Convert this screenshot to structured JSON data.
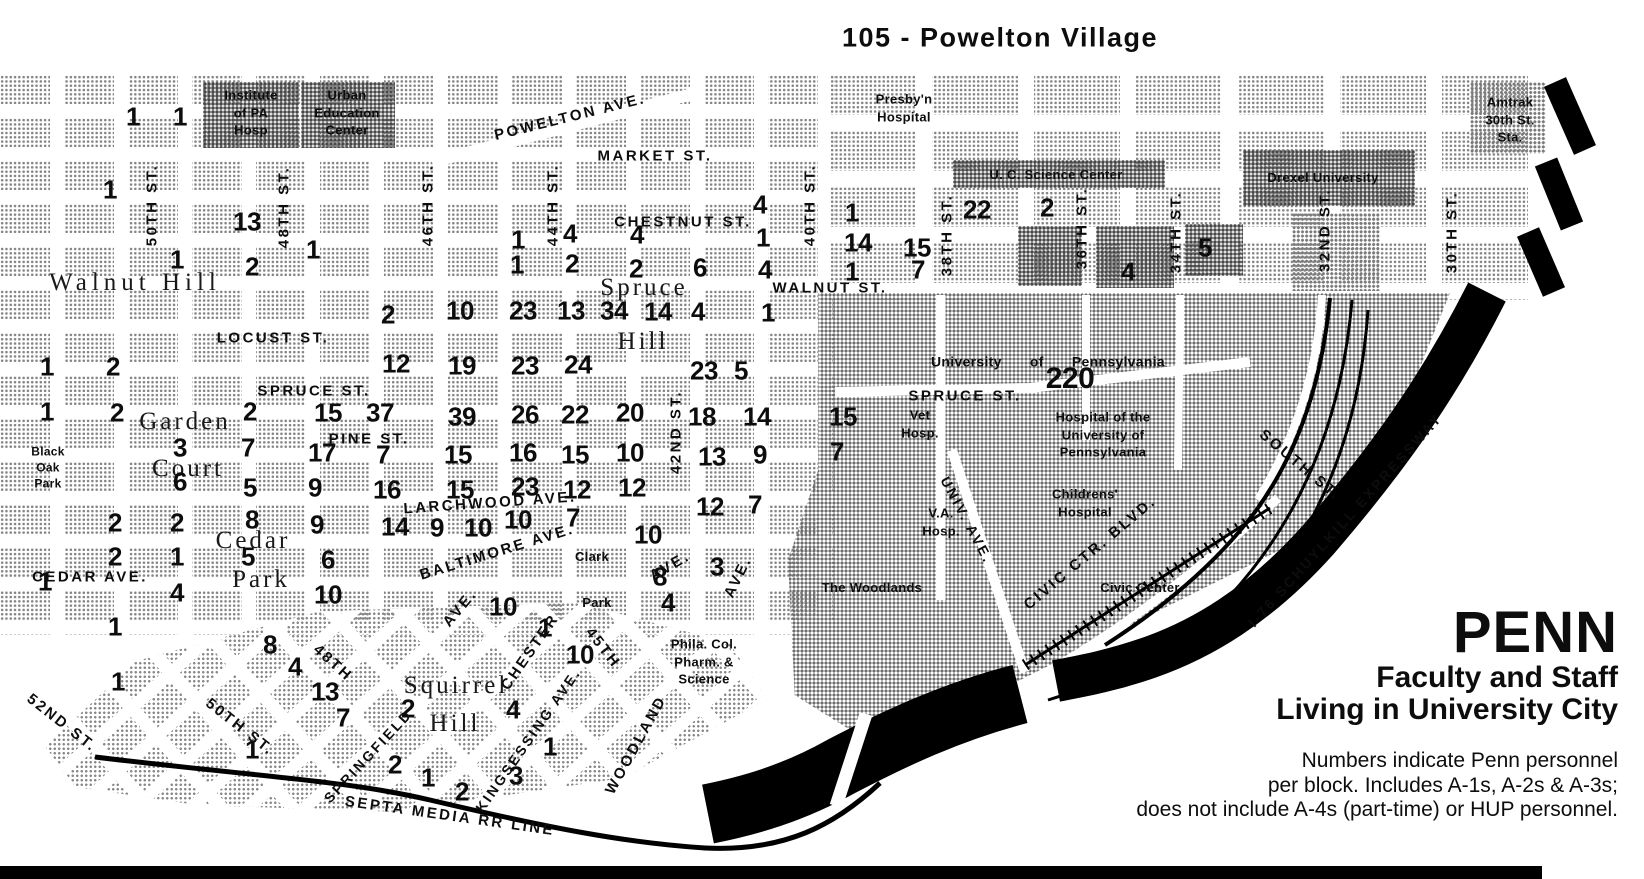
{
  "title": "105  - Powelton Village",
  "legend": {
    "brand": "PENN",
    "subtitle1": "Faculty and Staff",
    "subtitle2": "Living in University City",
    "note1": "Numbers indicate Penn personnel",
    "note2": "per block. Includes A-1s, A-2s & A-3s;",
    "note3": "does not include A-4s (part-time) or HUP personnel."
  },
  "colors": {
    "ink": "#0d0d0d",
    "paper": "#ffffff",
    "halftone_light": "#848484",
    "halftone_dark": "#474747"
  },
  "map": {
    "street_labels": [
      {
        "t": "POWELTON AVE.",
        "x": 570,
        "y": 117,
        "r": -14
      },
      {
        "t": "MARKET  ST.",
        "x": 655,
        "y": 156
      },
      {
        "t": "CHESTNUT  ST.",
        "x": 683,
        "y": 222
      },
      {
        "t": "WALNUT  ST.",
        "x": 830,
        "y": 288
      },
      {
        "t": "LOCUST ST.",
        "x": 273,
        "y": 338
      },
      {
        "t": "SPRUCE  ST.",
        "x": 314,
        "y": 391
      },
      {
        "t": "PINE  ST.",
        "x": 369,
        "y": 439
      },
      {
        "t": "LARCHWOOD AVE.",
        "x": 490,
        "y": 503,
        "r": -4
      },
      {
        "t": "BALTIMORE AVE.",
        "x": 497,
        "y": 552,
        "r": -17
      },
      {
        "t": "CEDAR  AVE.",
        "x": 90,
        "y": 577
      },
      {
        "t": "SPRUCE  ST.",
        "x": 965,
        "y": 396
      },
      {
        "t": "50TH ST.",
        "x": 152,
        "y": 205,
        "r": -90
      },
      {
        "t": "48TH ST.",
        "x": 284,
        "y": 207,
        "r": -90
      },
      {
        "t": "46TH ST.",
        "x": 428,
        "y": 205,
        "r": -90
      },
      {
        "t": "44TH ST.",
        "x": 553,
        "y": 205,
        "r": -90
      },
      {
        "t": "42ND ST.",
        "x": 676,
        "y": 432,
        "r": -90
      },
      {
        "t": "40TH ST.",
        "x": 810,
        "y": 205,
        "r": -90
      },
      {
        "t": "38TH ST.",
        "x": 947,
        "y": 235,
        "r": -90
      },
      {
        "t": "36TH ST.",
        "x": 1082,
        "y": 228,
        "r": -90
      },
      {
        "t": "34TH ST.",
        "x": 1176,
        "y": 232,
        "r": -90
      },
      {
        "t": "32ND ST.",
        "x": 1325,
        "y": 230,
        "r": -90
      },
      {
        "t": "30TH ST.",
        "x": 1452,
        "y": 232,
        "r": -90
      },
      {
        "t": "52ND  ST.",
        "x": 62,
        "y": 723,
        "r": 38
      },
      {
        "t": "50TH  ST.",
        "x": 240,
        "y": 727,
        "r": 38
      },
      {
        "t": "48TH",
        "x": 333,
        "y": 663,
        "r": 42
      },
      {
        "t": "45TH",
        "x": 603,
        "y": 648,
        "r": 52
      },
      {
        "t": "SPRINGFIELD",
        "x": 368,
        "y": 756,
        "r": -47,
        "fs": 14
      },
      {
        "t": "CHESTER",
        "x": 530,
        "y": 652,
        "r": -55
      },
      {
        "t": "AVE.",
        "x": 460,
        "y": 608,
        "r": -50
      },
      {
        "t": "KINGSESSING AVE.",
        "x": 528,
        "y": 740,
        "r": -55,
        "fs": 14
      },
      {
        "t": "WOODLAND",
        "x": 636,
        "y": 745,
        "r": -61
      },
      {
        "t": "AVE.",
        "x": 670,
        "y": 566,
        "r": -30
      },
      {
        "t": "AVE.",
        "x": 738,
        "y": 577,
        "r": -64
      },
      {
        "t": "SEPTA MEDIA RR LINE",
        "x": 450,
        "y": 816,
        "r": 8
      },
      {
        "t": "UNIV. AVE.",
        "x": 967,
        "y": 520,
        "r": 62,
        "fs": 14
      },
      {
        "t": "CIVIC CTR. BLVD.",
        "x": 1090,
        "y": 553,
        "r": -40
      },
      {
        "t": "SOUTH ST.",
        "x": 1300,
        "y": 465,
        "r": 40
      },
      {
        "t": "I-76 SCHUYLKILL EXPRESSWAY",
        "x": 1345,
        "y": 520,
        "r": -48,
        "fs": 14
      }
    ],
    "area_labels": [
      {
        "t": "Walnut Hill",
        "x": 135,
        "y": 283,
        "ls": 5
      },
      {
        "t": "Spruce",
        "x": 644,
        "y": 288
      },
      {
        "t": "Hill",
        "x": 643,
        "y": 342
      },
      {
        "t": "Garden",
        "x": 185,
        "y": 422
      },
      {
        "t": "Court",
        "x": 188,
        "y": 469
      },
      {
        "t": "Cedar",
        "x": 253,
        "y": 541
      },
      {
        "t": "Park",
        "x": 261,
        "y": 580
      },
      {
        "t": "Squirrel",
        "x": 456,
        "y": 686
      },
      {
        "t": "Hill",
        "x": 455,
        "y": 724
      }
    ],
    "poi_labels": [
      {
        "lines": [
          "Institute",
          "of PA",
          "Hosp"
        ],
        "x": 251,
        "y": 113
      },
      {
        "lines": [
          "Urban",
          "Education",
          "Center"
        ],
        "x": 347,
        "y": 113
      },
      {
        "lines": [
          "Presby'n",
          "Hospital"
        ],
        "x": 904,
        "y": 108
      },
      {
        "lines": [
          "U. C.  Science  Center"
        ],
        "x": 1056,
        "y": 175
      },
      {
        "lines": [
          "Drexel University"
        ],
        "x": 1323,
        "y": 178
      },
      {
        "lines": [
          "Amtrak",
          "30th St.",
          "Sta."
        ],
        "x": 1510,
        "y": 120
      },
      {
        "lines": [
          "University of Pennsylvania"
        ],
        "x": 1048,
        "y": 362,
        "ws": 24,
        "fs": 14
      },
      {
        "lines": [
          "Vet",
          "Hosp."
        ],
        "x": 920,
        "y": 424
      },
      {
        "lines": [
          "Hospital of the",
          "University of",
          "Pennsylvania"
        ],
        "x": 1103,
        "y": 435
      },
      {
        "lines": [
          "Childrens'",
          "Hospital"
        ],
        "x": 1085,
        "y": 503
      },
      {
        "lines": [
          "V.A.",
          "Hosp."
        ],
        "x": 941,
        "y": 522
      },
      {
        "lines": [
          "The Woodlands",
          "  "
        ],
        "x": 872,
        "y": 588
      },
      {
        "lines": [
          "Civic Center"
        ],
        "x": 1140,
        "y": 588
      },
      {
        "lines": [
          "Phila. Col.",
          "Pharm. &",
          "Science"
        ],
        "x": 704,
        "y": 662
      },
      {
        "lines": [
          "Clark"
        ],
        "x": 592,
        "y": 557
      },
      {
        "lines": [
          "Park"
        ],
        "x": 597,
        "y": 603
      },
      {
        "lines": [
          "Black",
          "Oak",
          "Park"
        ],
        "x": 48,
        "y": 468,
        "fs": 12
      }
    ],
    "numbers": [
      {
        "v": "1",
        "x": 133,
        "y": 117
      },
      {
        "v": "1",
        "x": 180,
        "y": 117
      },
      {
        "v": "1",
        "x": 110,
        "y": 190
      },
      {
        "v": "13",
        "x": 247,
        "y": 222
      },
      {
        "v": "1",
        "x": 313,
        "y": 250
      },
      {
        "v": "1",
        "x": 177,
        "y": 260
      },
      {
        "v": "2",
        "x": 252,
        "y": 267
      },
      {
        "v": "1",
        "x": 518,
        "y": 240
      },
      {
        "v": "4",
        "x": 570,
        "y": 234
      },
      {
        "v": "1",
        "x": 517,
        "y": 265
      },
      {
        "v": "2",
        "x": 572,
        "y": 264
      },
      {
        "v": "4",
        "x": 637,
        "y": 235
      },
      {
        "v": "2",
        "x": 636,
        "y": 269
      },
      {
        "v": "6",
        "x": 700,
        "y": 268
      },
      {
        "v": "4",
        "x": 760,
        "y": 205
      },
      {
        "v": "1",
        "x": 763,
        "y": 238
      },
      {
        "v": "4",
        "x": 765,
        "y": 270
      },
      {
        "v": "1",
        "x": 852,
        "y": 213
      },
      {
        "v": "14",
        "x": 858,
        "y": 243
      },
      {
        "v": "1",
        "x": 852,
        "y": 272
      },
      {
        "v": "22",
        "x": 977,
        "y": 210
      },
      {
        "v": "2",
        "x": 1047,
        "y": 208
      },
      {
        "v": "15",
        "x": 917,
        "y": 248
      },
      {
        "v": "7",
        "x": 918,
        "y": 270
      },
      {
        "v": "4",
        "x": 1128,
        "y": 272
      },
      {
        "v": "5",
        "x": 1205,
        "y": 248
      },
      {
        "v": "2",
        "x": 388,
        "y": 315
      },
      {
        "v": "10",
        "x": 460,
        "y": 311
      },
      {
        "v": "23",
        "x": 523,
        "y": 311
      },
      {
        "v": "13",
        "x": 571,
        "y": 311
      },
      {
        "v": "34",
        "x": 614,
        "y": 311
      },
      {
        "v": "14",
        "x": 658,
        "y": 312
      },
      {
        "v": "4",
        "x": 698,
        "y": 312
      },
      {
        "v": "1",
        "x": 768,
        "y": 313
      },
      {
        "v": "1",
        "x": 47,
        "y": 367
      },
      {
        "v": "2",
        "x": 113,
        "y": 367
      },
      {
        "v": "12",
        "x": 396,
        "y": 364
      },
      {
        "v": "19",
        "x": 462,
        "y": 366
      },
      {
        "v": "23",
        "x": 525,
        "y": 366
      },
      {
        "v": "24",
        "x": 578,
        "y": 365
      },
      {
        "v": "23",
        "x": 704,
        "y": 371
      },
      {
        "v": "5",
        "x": 741,
        "y": 371
      },
      {
        "v": "1",
        "x": 47,
        "y": 412
      },
      {
        "v": "2",
        "x": 117,
        "y": 413
      },
      {
        "v": "2",
        "x": 250,
        "y": 412
      },
      {
        "v": "15",
        "x": 328,
        "y": 413
      },
      {
        "v": "37",
        "x": 380,
        "y": 413
      },
      {
        "v": "39",
        "x": 462,
        "y": 417
      },
      {
        "v": "26",
        "x": 525,
        "y": 415
      },
      {
        "v": "22",
        "x": 575,
        "y": 415
      },
      {
        "v": "20",
        "x": 630,
        "y": 413
      },
      {
        "v": "18",
        "x": 702,
        "y": 417
      },
      {
        "v": "14",
        "x": 757,
        "y": 417
      },
      {
        "v": "15",
        "x": 843,
        "y": 417
      },
      {
        "v": "220",
        "x": 1070,
        "y": 379,
        "fs": 30
      },
      {
        "v": "3",
        "x": 180,
        "y": 448
      },
      {
        "v": "7",
        "x": 248,
        "y": 448
      },
      {
        "v": "17",
        "x": 322,
        "y": 453
      },
      {
        "v": "7",
        "x": 383,
        "y": 455
      },
      {
        "v": "15",
        "x": 458,
        "y": 455
      },
      {
        "v": "16",
        "x": 523,
        "y": 453
      },
      {
        "v": "15",
        "x": 575,
        "y": 455
      },
      {
        "v": "10",
        "x": 630,
        "y": 453
      },
      {
        "v": "13",
        "x": 712,
        "y": 457
      },
      {
        "v": "9",
        "x": 760,
        "y": 455
      },
      {
        "v": "7",
        "x": 837,
        "y": 452
      },
      {
        "v": "6",
        "x": 180,
        "y": 482
      },
      {
        "v": "5",
        "x": 250,
        "y": 488
      },
      {
        "v": "9",
        "x": 315,
        "y": 488
      },
      {
        "v": "16",
        "x": 387,
        "y": 490
      },
      {
        "v": "15",
        "x": 460,
        "y": 490
      },
      {
        "v": "23",
        "x": 525,
        "y": 487
      },
      {
        "v": "12",
        "x": 577,
        "y": 490
      },
      {
        "v": "12",
        "x": 632,
        "y": 488
      },
      {
        "v": "12",
        "x": 710,
        "y": 507
      },
      {
        "v": "7",
        "x": 755,
        "y": 505
      },
      {
        "v": "2",
        "x": 115,
        "y": 523
      },
      {
        "v": "2",
        "x": 177,
        "y": 523
      },
      {
        "v": "8",
        "x": 252,
        "y": 520
      },
      {
        "v": "9",
        "x": 317,
        "y": 525
      },
      {
        "v": "14",
        "x": 395,
        "y": 527
      },
      {
        "v": "9",
        "x": 437,
        "y": 528
      },
      {
        "v": "10",
        "x": 478,
        "y": 528
      },
      {
        "v": "10",
        "x": 518,
        "y": 520
      },
      {
        "v": "7",
        "x": 573,
        "y": 518
      },
      {
        "v": "10",
        "x": 648,
        "y": 535
      },
      {
        "v": "2",
        "x": 115,
        "y": 557
      },
      {
        "v": "1",
        "x": 177,
        "y": 557
      },
      {
        "v": "5",
        "x": 248,
        "y": 557
      },
      {
        "v": "6",
        "x": 328,
        "y": 560
      },
      {
        "v": "8",
        "x": 660,
        "y": 577
      },
      {
        "v": "3",
        "x": 717,
        "y": 567
      },
      {
        "v": "1",
        "x": 45,
        "y": 582
      },
      {
        "v": "4",
        "x": 177,
        "y": 593
      },
      {
        "v": "10",
        "x": 328,
        "y": 595
      },
      {
        "v": "10",
        "x": 503,
        "y": 607
      },
      {
        "v": "4",
        "x": 668,
        "y": 603
      },
      {
        "v": "1",
        "x": 115,
        "y": 627
      },
      {
        "v": "1",
        "x": 118,
        "y": 682
      },
      {
        "v": "8",
        "x": 270,
        "y": 645
      },
      {
        "v": "4",
        "x": 295,
        "y": 667
      },
      {
        "v": "13",
        "x": 325,
        "y": 692
      },
      {
        "v": "7",
        "x": 343,
        "y": 718
      },
      {
        "v": "1",
        "x": 252,
        "y": 750
      },
      {
        "v": "2",
        "x": 408,
        "y": 709
      },
      {
        "v": "2",
        "x": 395,
        "y": 765
      },
      {
        "v": "1",
        "x": 428,
        "y": 778
      },
      {
        "v": "2",
        "x": 462,
        "y": 792
      },
      {
        "v": "3",
        "x": 516,
        "y": 776
      },
      {
        "v": "1",
        "x": 550,
        "y": 747
      },
      {
        "v": "4",
        "x": 513,
        "y": 710
      },
      {
        "v": "10",
        "x": 580,
        "y": 655
      },
      {
        "v": "1",
        "x": 545,
        "y": 628
      }
    ]
  }
}
